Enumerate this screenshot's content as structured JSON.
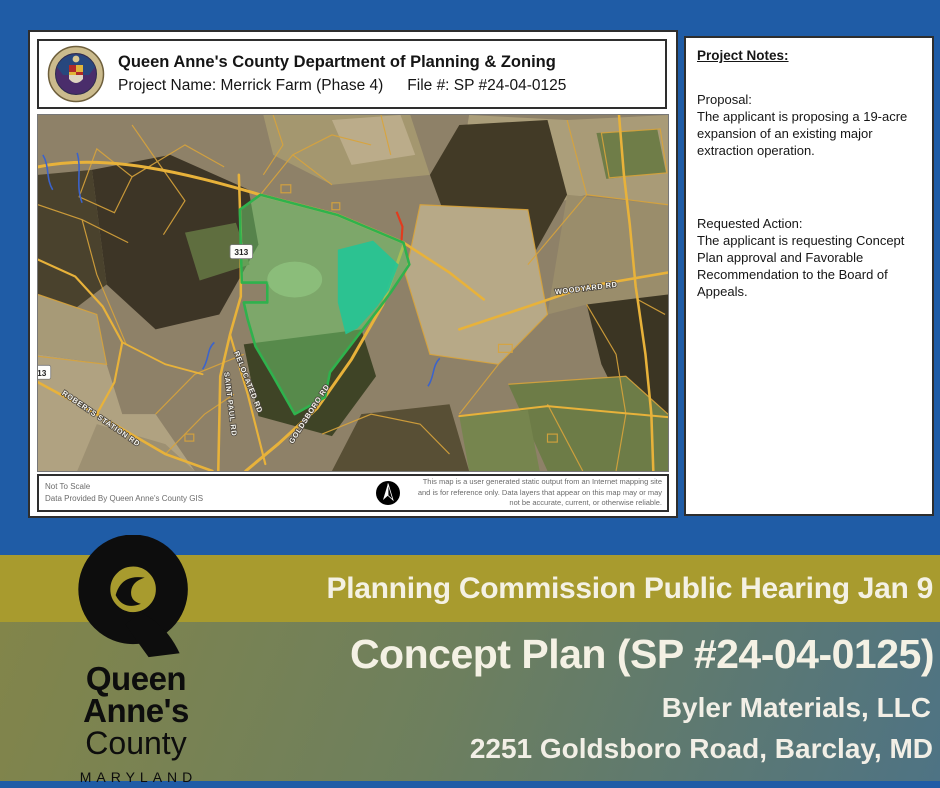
{
  "document": {
    "header": {
      "title": "Queen Anne's County Department of Planning & Zoning",
      "project_name_label": "Project Name: Merrick Farm (Phase 4)",
      "file_label": "File #: SP #24-04-0125"
    },
    "map": {
      "route_shield": "313",
      "roads": {
        "woodyard": "WOODYARD RD",
        "saint_paul": "SAINT PAUL RD",
        "roberts_station": "ROBERTS STATION RD",
        "relocated": "RELOCATED RD",
        "goldsboro": "GOLDSBORO RD"
      }
    },
    "footer": {
      "scale_note": "Not To Scale",
      "data_note": "Data Provided By Queen Anne's County GIS",
      "disclaimer": "This map is a user generated static output from an Internet mapping site and is for reference only. Data layers that appear on this map may or may not be accurate, current, or otherwise reliable."
    }
  },
  "notes_panel": {
    "heading": "Project Notes:",
    "proposal_label": "Proposal:",
    "proposal_text": "The applicant is proposing a 19-acre expansion of an existing major extraction operation.",
    "action_label": "Requested Action:",
    "action_text": "The applicant is requesting Concept Plan approval and Favorable Recommendation to the Board of Appeals."
  },
  "banner": {
    "hearing": "Planning Commission Public Hearing Jan 9",
    "plan_title": "Concept Plan (SP #24-04-0125)",
    "applicant": "Byler Materials, LLC",
    "address": "2251 Goldsboro Road, Barclay, MD"
  },
  "logo": {
    "line1": "Queen",
    "line2": "Anne's",
    "line3": "County",
    "line4": "MARYLAND"
  },
  "colors": {
    "background_blue": "#1f5ca6",
    "banner_olive": "#a89b2e",
    "gradient_start": "#82854a",
    "gradient_end": "#4e7384",
    "parcel_highlight": "#2fb24d",
    "pond_teal": "#25c495",
    "parcel_lines": "#d9a43b"
  }
}
